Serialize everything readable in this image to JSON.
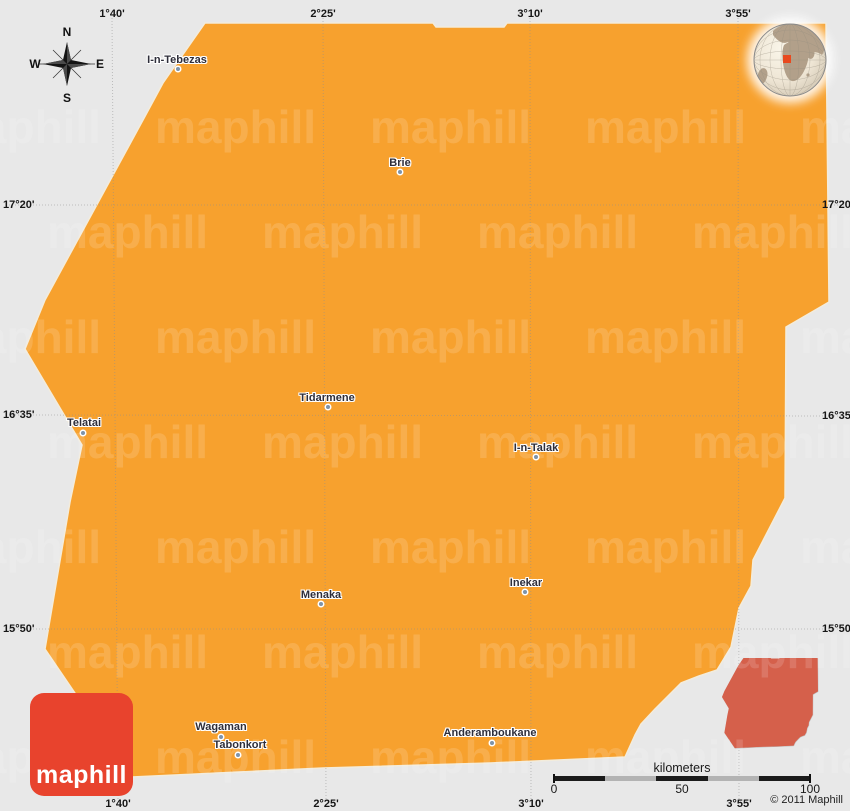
{
  "map": {
    "background_color": "#E8E8E8",
    "region": {
      "label": "Menaka district",
      "fill": "#F7A12E",
      "stroke": "#F3ECDC",
      "points": "205,23 433,23 436,27 504,27 507,23 826,23 829,302 786,327 785,498 753,560 751,586 739,608 731,647 717,670 699,676 681,683 670,694 655,709 641,724 635,735 625,757 490,763 323,768 132,777 45,649 70,502 82,445 25,349 45,300 143,120 163,83"
    },
    "inset": {
      "fill": "#D5604B"
    },
    "watermark": {
      "text": "maphill"
    },
    "logo": {
      "text": "maphill",
      "background": "#E8432D"
    },
    "copyright": "© 2011 Maphill",
    "compass": {
      "n": "N",
      "e": "E",
      "s": "S",
      "w": "W"
    },
    "scalebar": {
      "title": "kilometers",
      "labels": [
        {
          "text": "0",
          "x": 2
        },
        {
          "text": "50",
          "x": 130
        },
        {
          "text": "100",
          "x": 258
        }
      ],
      "segment_colors": [
        "#1b1b1b",
        "#b3b3b3",
        "#1b1b1b",
        "#b3b3b3",
        "#1b1b1b"
      ]
    },
    "grid": {
      "top_labels": [
        {
          "text": "1°40'",
          "x": 112
        },
        {
          "text": "2°25'",
          "x": 323
        },
        {
          "text": "3°10'",
          "x": 530
        },
        {
          "text": "3°55'",
          "x": 738
        }
      ],
      "bottom_labels": [
        {
          "text": "1°40'",
          "x": 118
        },
        {
          "text": "2°25'",
          "x": 326
        },
        {
          "text": "3°10'",
          "x": 531
        },
        {
          "text": "3°55'",
          "x": 739
        }
      ],
      "left_labels": [
        {
          "text": "17°20'",
          "y": 205
        },
        {
          "text": "16°35'",
          "y": 415
        },
        {
          "text": "15°50'",
          "y": 629
        }
      ],
      "right_labels": [
        {
          "text": "17°20'",
          "y": 205
        },
        {
          "text": "16°35'",
          "y": 416
        },
        {
          "text": "15°50'",
          "y": 629
        }
      ],
      "vlines": [
        [
          112,
          118
        ],
        [
          323,
          326
        ],
        [
          530,
          531
        ],
        [
          738,
          739
        ]
      ],
      "hlines": [
        [
          205,
          205
        ],
        [
          415,
          416
        ],
        [
          629,
          629
        ]
      ]
    },
    "towns": [
      {
        "name": "I-n-Tebezas",
        "label_x": 177,
        "label_y": 60,
        "dot_x": 178,
        "dot_y": 69
      },
      {
        "name": "Brie",
        "label_x": 400,
        "label_y": 163,
        "dot_x": 400,
        "dot_y": 172
      },
      {
        "name": "Tidarmene",
        "label_x": 327,
        "label_y": 398,
        "dot_x": 328,
        "dot_y": 407
      },
      {
        "name": "Telatai",
        "label_x": 84,
        "label_y": 423,
        "dot_x": 83,
        "dot_y": 433
      },
      {
        "name": "I-n-Talak",
        "label_x": 536,
        "label_y": 448,
        "dot_x": 536,
        "dot_y": 457
      },
      {
        "name": "Menaka",
        "label_x": 321,
        "label_y": 595,
        "dot_x": 321,
        "dot_y": 604
      },
      {
        "name": "Inekar",
        "label_x": 526,
        "label_y": 583,
        "dot_x": 525,
        "dot_y": 592
      },
      {
        "name": "Wagaman",
        "label_x": 221,
        "label_y": 727,
        "dot_x": 221,
        "dot_y": 737
      },
      {
        "name": "Tabonkort",
        "label_x": 240,
        "label_y": 745,
        "dot_x": 238,
        "dot_y": 755
      },
      {
        "name": "Anderamboukane",
        "label_x": 490,
        "label_y": 733,
        "dot_x": 492,
        "dot_y": 743
      }
    ]
  }
}
